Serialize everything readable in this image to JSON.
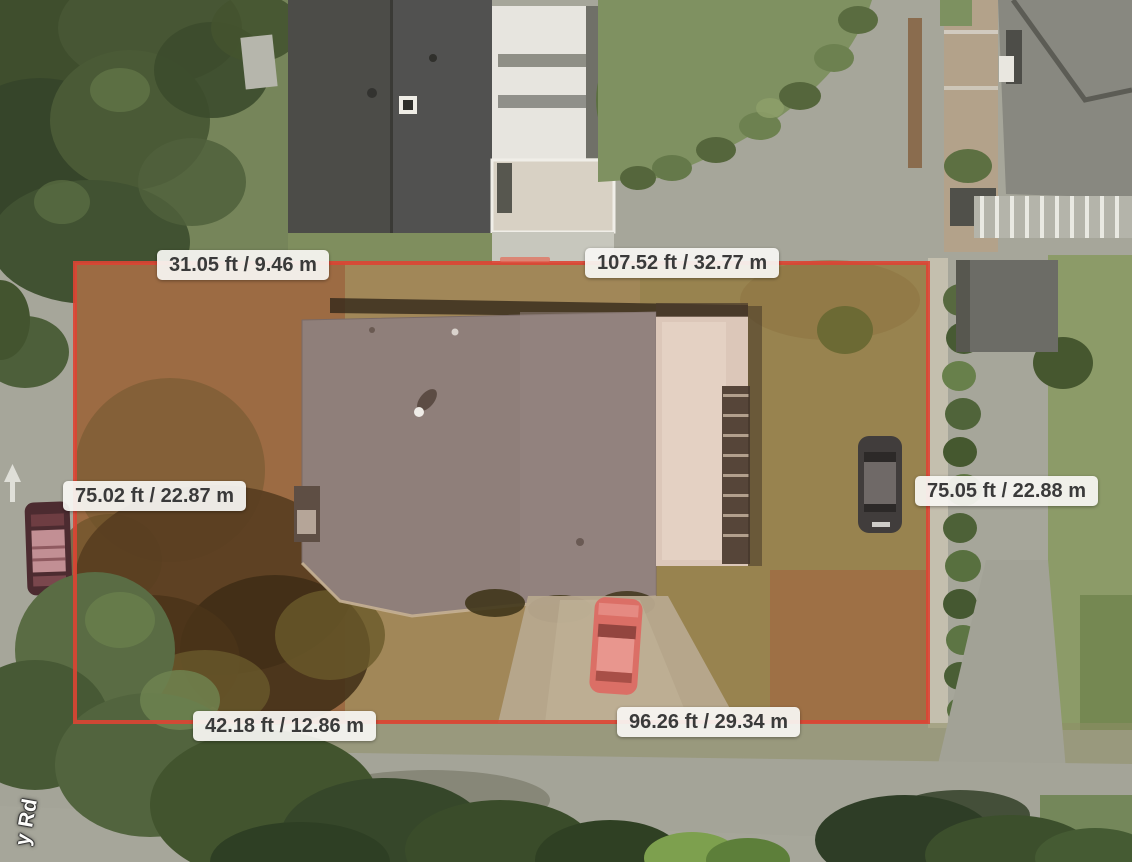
{
  "map": {
    "boundary_color": "#dd4433",
    "label_background": "#f7f5f1",
    "label_text_color": "#3a3a3a",
    "street_label": "y Rd",
    "measurements": {
      "top_left": "31.05 ft / 9.46 m",
      "top_right": "107.52 ft / 32.77 m",
      "left": "75.02 ft / 22.87 m",
      "right": "75.05 ft / 22.88 m",
      "bottom_left": "42.18 ft / 12.86 m",
      "bottom_right": "96.26 ft / 29.34 m"
    }
  }
}
